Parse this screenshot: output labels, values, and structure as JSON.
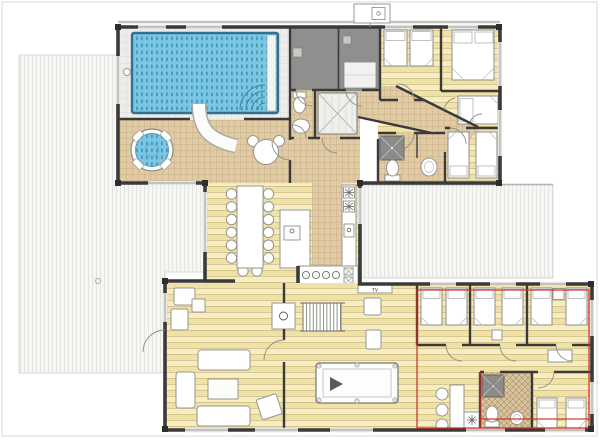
{
  "document": {
    "type": "floor-plan",
    "subject": "two-building villa with indoor pool and bedroom wings"
  },
  "labels": {
    "tv": "TV"
  },
  "palette": {
    "wall": "#3a3a3a",
    "pool_water": "#79c7e3",
    "pool_water_line": "#4898ba",
    "wood_floor": "#f6edc2",
    "wood_floor_alt": "#efe2a7",
    "wood_floor_line": "#cdbb82",
    "tile_floor": "#e0cba4",
    "tile_floor_line": "#c0a57c",
    "pool_deck": "#ededeb",
    "pool_deck_line": "#d7d7d4",
    "outdoor_deck": "#f6f6f4",
    "outdoor_deck_line": "#e4e4e1",
    "sauna_gray": "#8f8f8d",
    "highlight_red": "#cf2b20",
    "furniture": "#ffffff"
  },
  "upper_building": {
    "rooms": [
      "pool-hall",
      "spa-terrace",
      "sauna",
      "storage-room",
      "wc-north",
      "wardrobe-corridor",
      "bedroom-1",
      "bedroom-2",
      "bedroom-3",
      "bedroom-4",
      "bathroom-middle",
      "kitchen",
      "dining-area",
      "hallway"
    ]
  },
  "lower_building": {
    "rooms": [
      "living-room",
      "games-room",
      "stair",
      "bar",
      "bedroom-a",
      "bedroom-b",
      "bedroom-c",
      "bedroom-d",
      "bathroom-south",
      "corridor"
    ]
  },
  "annotation": {
    "highlighted_area": "lower-right bedroom wing",
    "color": "#cf2b20"
  }
}
